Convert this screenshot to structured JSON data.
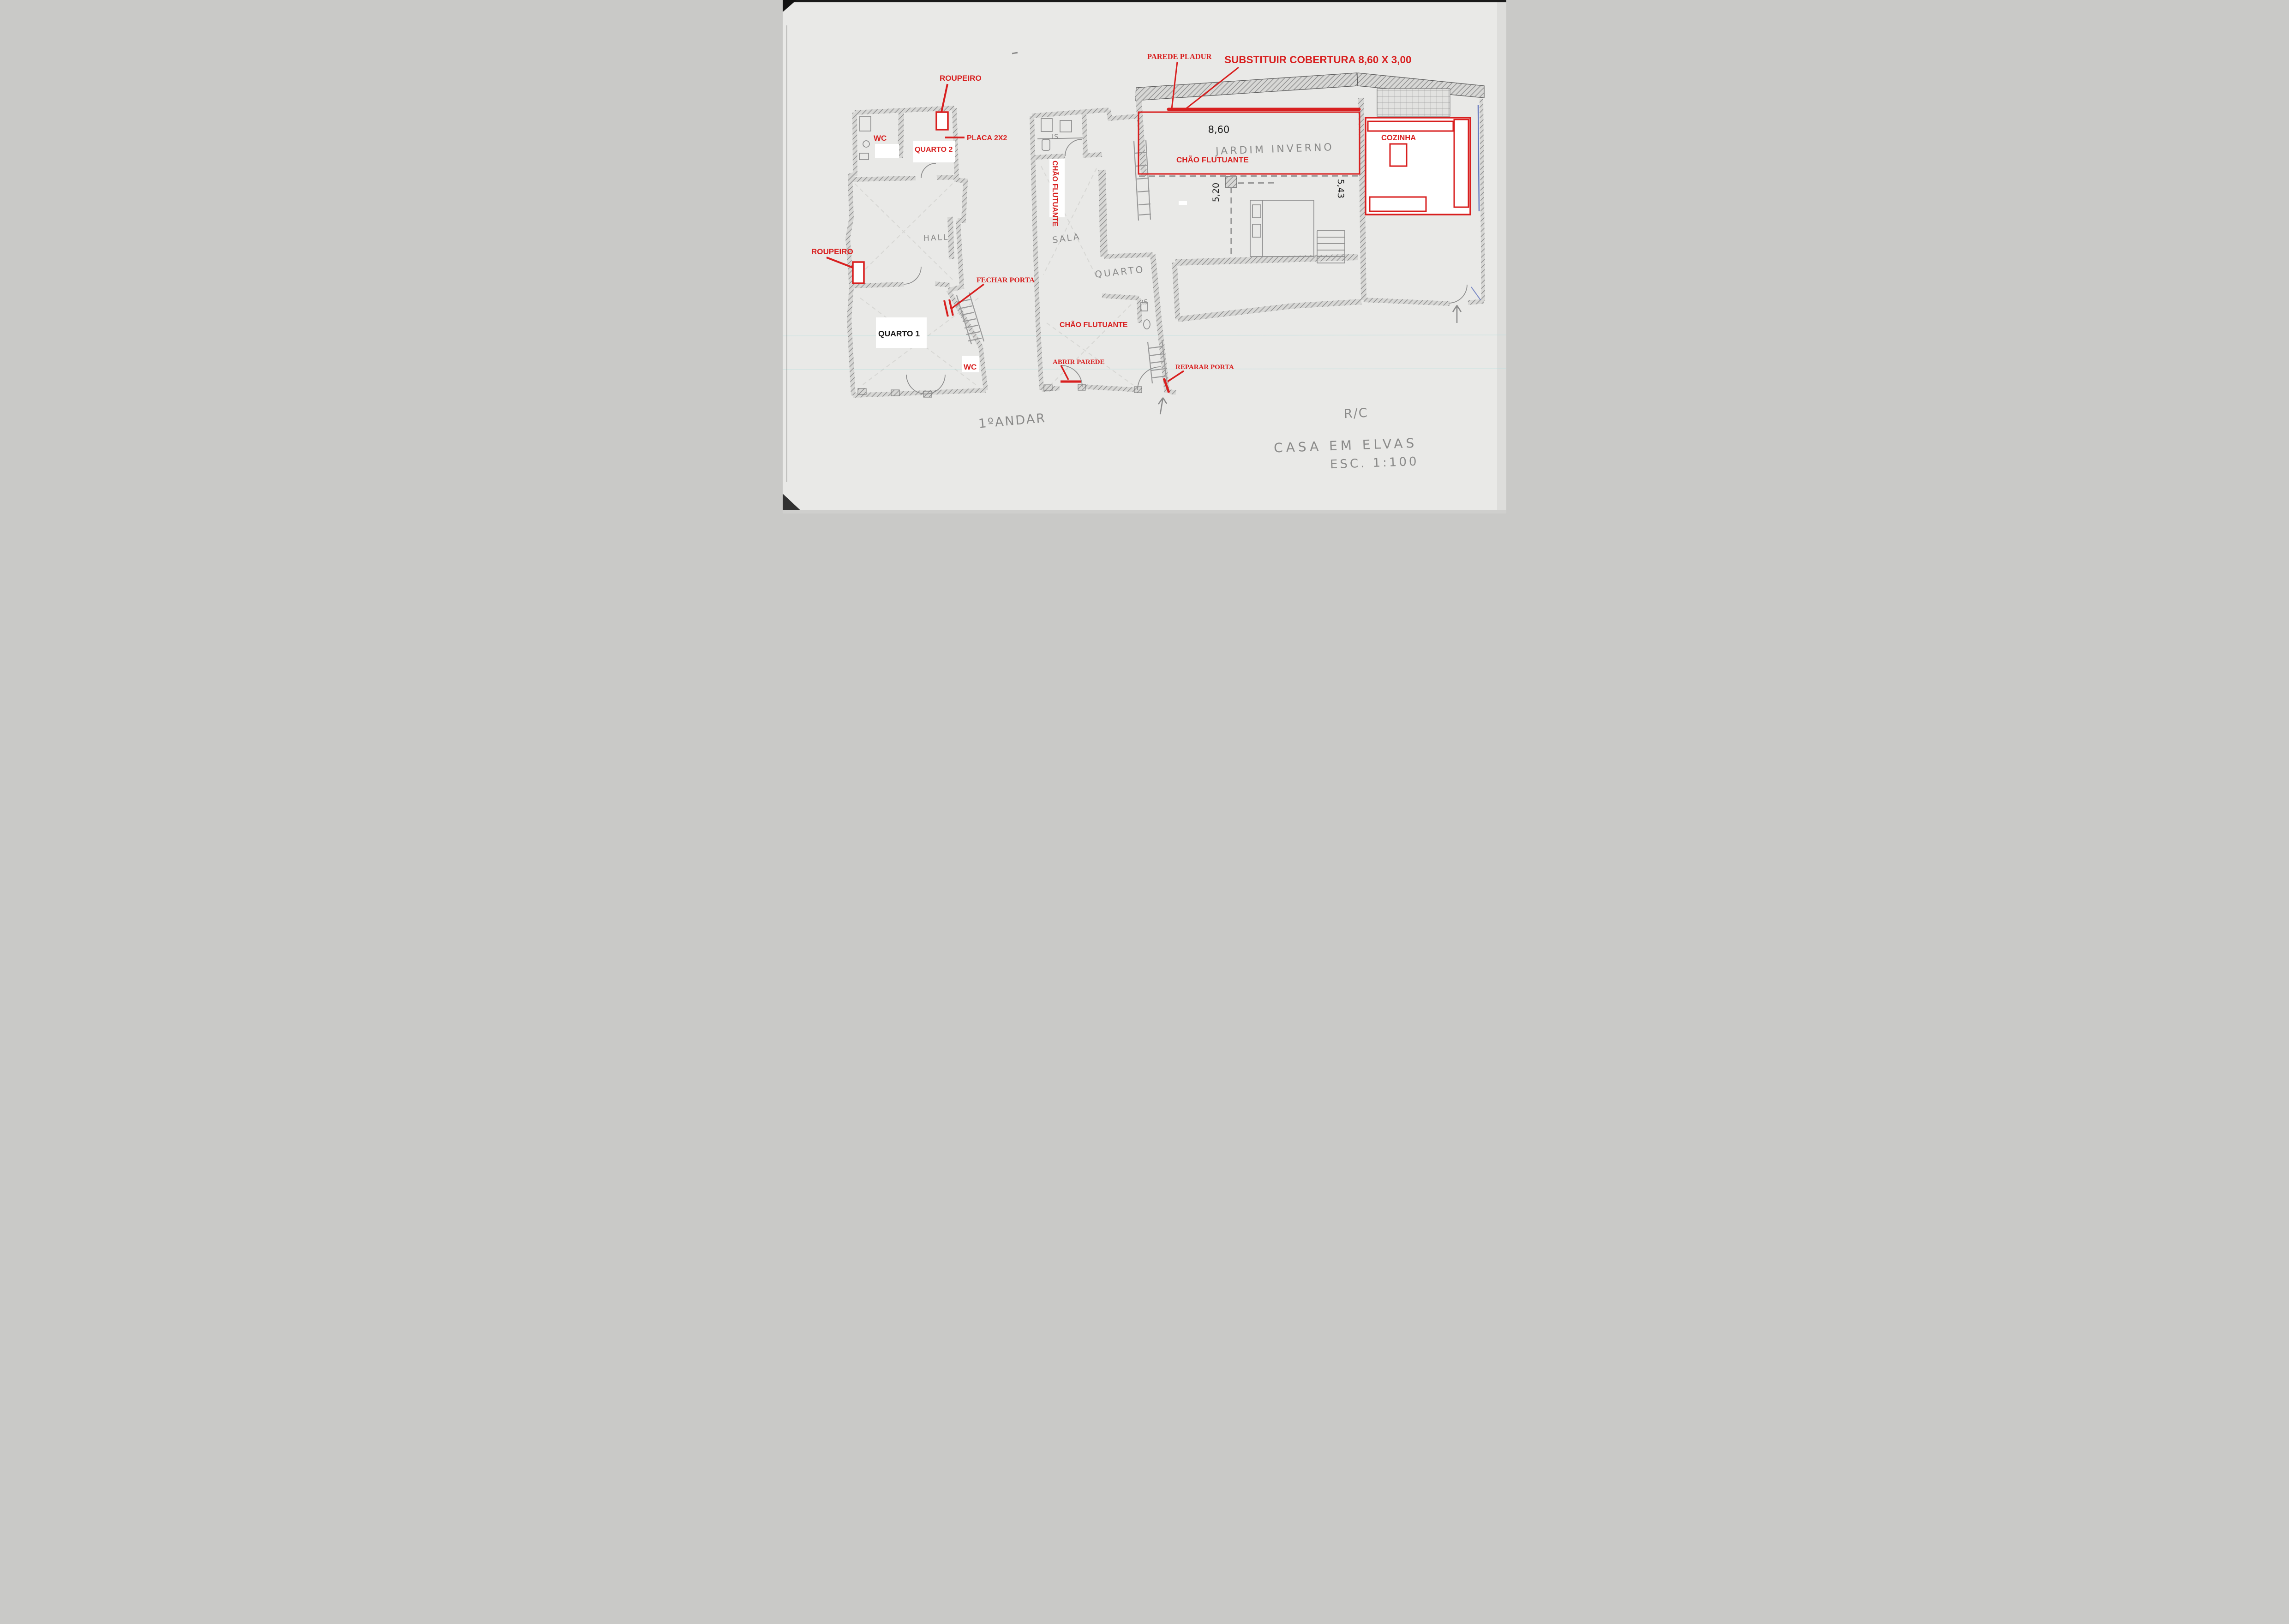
{
  "colors": {
    "paper": "#e9e9e7",
    "annotation_red": "#d81f1f",
    "pencil_gray": "#7d7d7d",
    "ink_black": "#161616",
    "pen_blue": "#4a5fb5"
  },
  "floor1": {
    "title": "1ºANDAR",
    "roupeiro_top": "ROUPEIRO",
    "placa": "PLACA 2X2",
    "wc_upper": "WC",
    "quarto2": "QUARTO 2",
    "hall": "HALL",
    "roupeiro_left": "ROUPEIRO",
    "fechar_porta": "FECHAR PORTA",
    "quarto1": "QUARTO 1",
    "wc_lower": "WC"
  },
  "ground": {
    "title": "R/C",
    "parede_pladur": "PAREDE PLADUR",
    "substituir_cobertura": "SUBSTITUIR COBERTURA 8,60 X 3,00",
    "is_top": "IS",
    "chao_flutuante_corridor": "CHÃO FLUTUANTE",
    "sala": "SALA",
    "quarto": "QUARTO",
    "is_mid": "IS",
    "chao_flutuante_room": "CHÃO FLUTUANTE",
    "abrir_parede": "ABRIR PAREDE",
    "reparar_porta": "REPARAR PORTA",
    "jardim_inverno": "JARDIM INVERNO",
    "chao_flutuante_jardim": "CHÃO FLUTUANTE",
    "cozinha": "COZINHA",
    "dim_width": "8,60",
    "dim_left": "5,20",
    "dim_right": "5,43"
  },
  "footer": {
    "project": "CASA EM ELVAS",
    "scale": "ESC. 1:100"
  }
}
